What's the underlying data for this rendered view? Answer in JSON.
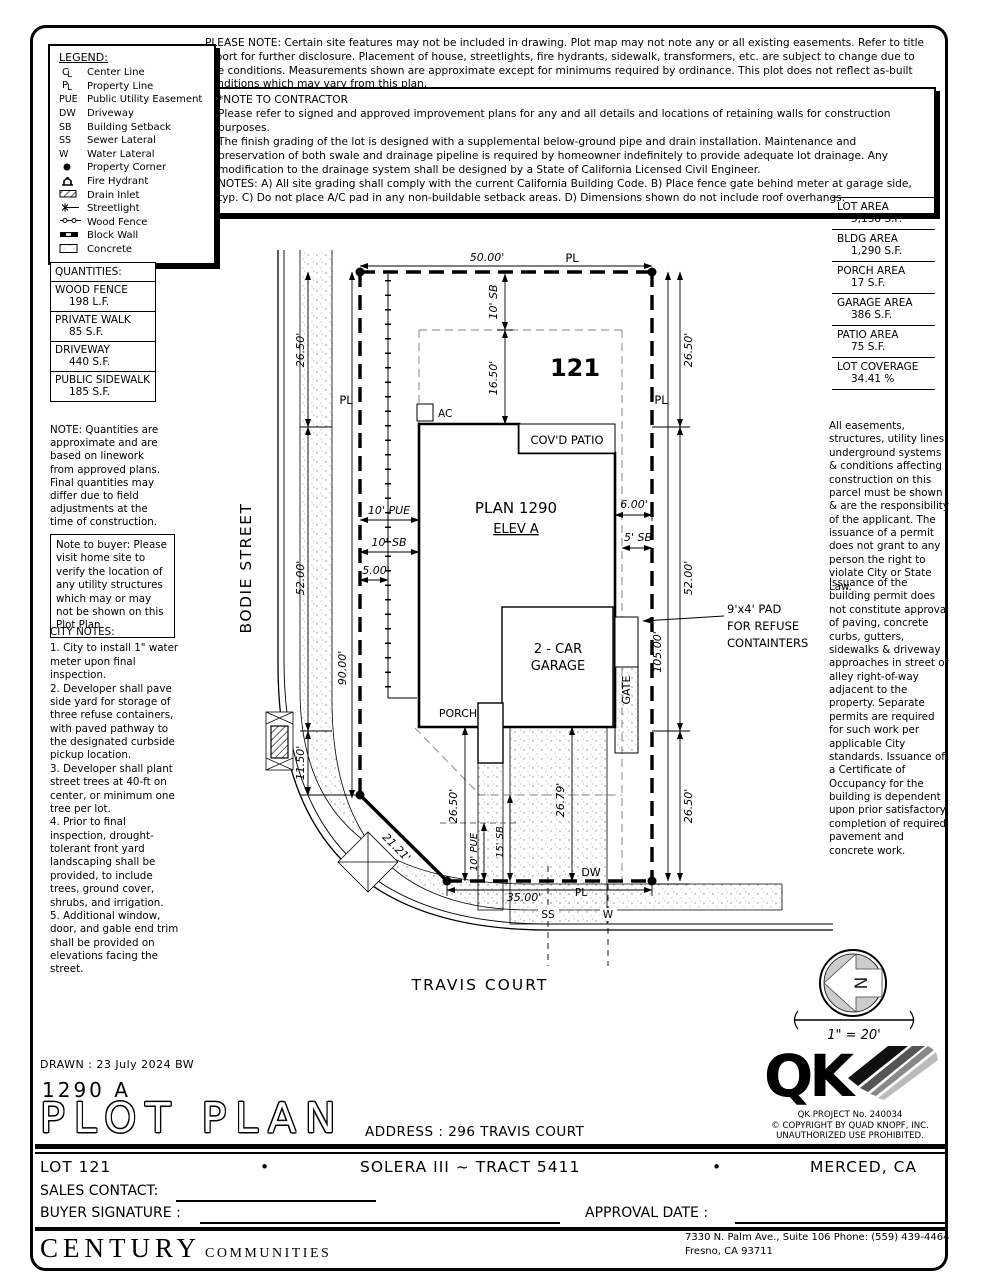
{
  "header": {
    "please_note": "PLEASE NOTE:  Certain site features may not be included in drawing.  Plot map may not note any or all existing easements. Refer to title report for further disclosure.  Placement of house, streetlights, fire hydrants, sidewalk, transformers, etc. are subject to change due to site conditions.  Measurements shown are approximate except for minimums required by ordinance.  This plot does not reflect as-built conditions which may vary from this plan.",
    "contractor_title": "*NOTE TO CONTRACTOR",
    "contractor_body": "Please refer to signed and approved improvement plans for any and all details and locations of retaining walls for construction purposes.\nThe finish grading of the lot is designed with a supplemental below-ground pipe and drain installation.  Maintenance and preservation of both swale and drainage pipeline is required by homeowner indefinitely to provide adequate lot drainage.  Any modification to the drainage system shall be designed by a State of California Licensed Civil Engineer.\nNOTES:  A) All site grading shall comply with the current California Building Code.  B) Place fence gate behind meter at garage side, typ.  C) Do not place A/C pad in any non-buildable setback areas.  D) Dimensions shown do not include roof overhangs."
  },
  "legend": {
    "title": "LEGEND:",
    "items": [
      {
        "s1": "C",
        "s2": "L",
        "label": "Center Line"
      },
      {
        "s1": "P",
        "s2": "L",
        "label": "Property Line"
      },
      {
        "sym": "PUE",
        "label": "Public Utility Easement"
      },
      {
        "sym": "DW",
        "label": "Driveway"
      },
      {
        "sym": "SB",
        "label": "Building Setback"
      },
      {
        "sym": "SS",
        "label": "Sewer Lateral"
      },
      {
        "sym": "W",
        "label": "Water Lateral"
      },
      {
        "label": "Property Corner"
      },
      {
        "label": "Fire Hydrant"
      },
      {
        "label": "Drain Inlet"
      },
      {
        "label": "Streetlight"
      },
      {
        "label": "Wood Fence"
      },
      {
        "label": "Block Wall"
      },
      {
        "label": "Concrete"
      }
    ]
  },
  "quantities": {
    "title": "QUANTITIES:",
    "rows": [
      {
        "name": "WOOD FENCE",
        "value": "198 L.F."
      },
      {
        "name": "PRIVATE WALK",
        "value": "85 S.F."
      },
      {
        "name": "DRIVEWAY",
        "value": "440 S.F."
      },
      {
        "name": "PUBLIC SIDEWALK",
        "value": "185 S.F."
      }
    ],
    "note": "NOTE: Quantities are approximate and are based on linework from approved plans.  Final quantities may differ due to field adjustments at the time of construction."
  },
  "buyer_note": "Note to buyer: Please visit home site to verify the location of any utility structures which may or may not be shown on this Plot Plan.",
  "city_notes": {
    "title": "CITY NOTES:",
    "body": "1. City to install 1\" water meter upon final inspection.\n2. Developer shall pave side yard for storage of three refuse containers, with paved pathway to the designated curbside pickup location.\n3. Developer shall plant street trees at 40-ft on center, or minimum one tree per lot.\n4. Prior to final inspection, drought-tolerant front yard landscaping shall be provided, to include trees, ground cover, shrubs, and irrigation.\n5. Additional window, door, and gable end trim shall be provided on elevations facing the street."
  },
  "areas": {
    "rows": [
      {
        "name": "LOT AREA",
        "value": "5,138 S.F."
      },
      {
        "name": "BLDG AREA",
        "value": "1,290 S.F."
      },
      {
        "name": "PORCH AREA",
        "value": "17 S.F."
      },
      {
        "name": "GARAGE AREA",
        "value": "386 S.F."
      },
      {
        "name": "PATIO AREA",
        "value": "75 S.F."
      },
      {
        "name": "LOT COVERAGE",
        "value": "34.41 %"
      }
    ]
  },
  "easement_notes": {
    "p1": "All easements, structures, utility lines, underground systems & conditions affecting construction on this parcel must be shown & are the responsibility of the applicant. The issuance of a permit does not grant to any person the right to violate City or State Law.",
    "p2": "Issuance of the building permit does not constitute approval of paving, concrete curbs, gutters, sidewalks & driveway approaches in street or alley right-of-way adjacent to the property. Separate permits are required for such work per applicable City standards. Issuance of a Certificate of Occupancy for the building is dependent upon prior satisfactory completion of required pavement and concrete work."
  },
  "plot": {
    "lot_number": "121",
    "street_left": "BODIE STREET",
    "street_bottom": "TRAVIS COURT",
    "plan": "PLAN 1290",
    "elev": "ELEV A",
    "garage_line1": "2 - CAR",
    "garage_line2": "GARAGE",
    "porch": "PORCH",
    "patio": "COV'D PATIO",
    "ac": "AC",
    "gate": "GATE",
    "refuse_line1": "9'x4' PAD",
    "refuse_line2": "FOR REFUSE",
    "refuse_line3": "CONTAINTERS",
    "pl": "PL",
    "dw": "DW",
    "ss": "SS",
    "w": "W",
    "dims": {
      "top": "50.00'",
      "left_26a": "26.50'",
      "left_52": "52.00'",
      "left_1150": "11.50'",
      "left_90": "90.00'",
      "right_26a": "26.50'",
      "right_52": "52.00'",
      "right_26b": "26.50'",
      "right_105": "105.00'",
      "sb10_top": "10' SB",
      "d1650": "16.50'",
      "pue10_left": "10' PUE",
      "sb10_left": "10' SB",
      "d500": "5.00'",
      "d600": "6.00'",
      "sb5": "5' SB",
      "d2650_house": "26.50'",
      "d2679": "26.79'",
      "pue10_bot": "10' PUE",
      "sb15": "15' SB",
      "d3500": "35.00'",
      "d2121": "21.21'"
    }
  },
  "compass": {
    "n": "N",
    "scale": "1\" = 20'"
  },
  "title_block": {
    "drawn": "DRAWN :  23 July 2024  BW",
    "plan_code": "1290  A",
    "title": "PLOT PLAN",
    "address_label": "ADDRESS :",
    "address": "296 TRAVIS COURT",
    "lot": "LOT 121",
    "bullet": "•",
    "tract": "SOLERA III ~ TRACT 5411",
    "city": "MERCED, CA",
    "sales_label": "SALES CONTACT:",
    "signature_label": "BUYER SIGNATURE :",
    "approval_label": "APPROVAL DATE :",
    "qk_letters": "QK",
    "qk_project": "QK PROJECT No. 240034",
    "qk_copyright": "©   COPYRIGHT BY QUAD KNOPF, INC.",
    "qk_prohibited": "UNAUTHORIZED USE PROHIBITED.",
    "brand_main": "CENTURY",
    "brand_sub": "COMMUNITIES",
    "office_line1": "7330 N. Palm Ave., Suite 106    Phone:  (559) 439-4464",
    "office_line2": "Fresno, CA  93711"
  }
}
